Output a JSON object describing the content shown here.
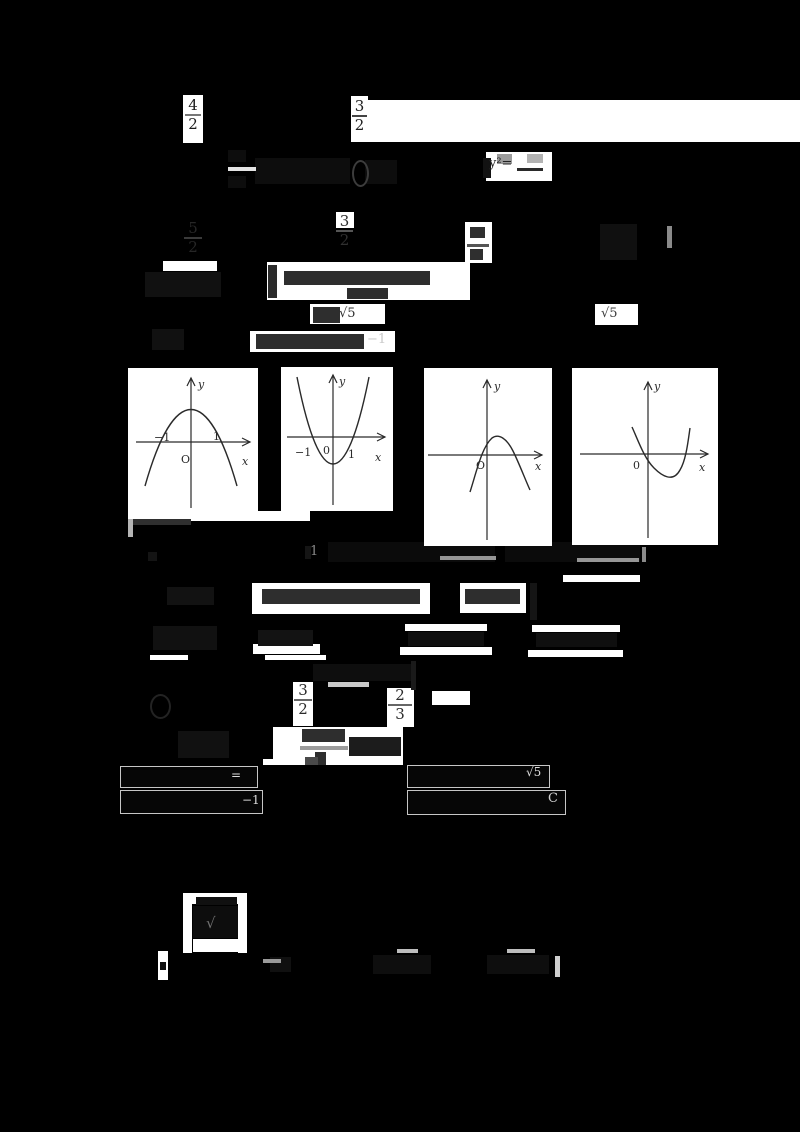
{
  "canvas": {
    "width": 800,
    "height": 1132,
    "background": "#000000"
  },
  "palette": {
    "paper": "#ffffff",
    "faint_ink": "#111111",
    "paper_ink": "#2e2e2e",
    "gray_ink": "#969696",
    "bright_ink": "#dcdcdc",
    "graph_ink": "#2a2a2a",
    "box_border": "#c6c6c6"
  },
  "paper_blocks": [
    {
      "r": [
        183,
        95,
        20,
        48
      ]
    },
    {
      "r": [
        351,
        96,
        17,
        46
      ]
    },
    {
      "r": [
        367,
        100,
        433,
        42
      ]
    },
    {
      "r": [
        486,
        152,
        66,
        29
      ]
    },
    {
      "r": [
        336,
        212,
        18,
        16
      ]
    },
    {
      "r": [
        465,
        222,
        27,
        41
      ]
    },
    {
      "r": [
        163,
        261,
        54,
        10
      ]
    },
    {
      "r": [
        267,
        262,
        203,
        38
      ]
    },
    {
      "r": [
        310,
        304,
        75,
        20
      ]
    },
    {
      "r": [
        595,
        304,
        43,
        21
      ]
    },
    {
      "r": [
        250,
        331,
        145,
        21
      ]
    },
    {
      "r": [
        618,
        230,
        18,
        26
      ]
    },
    {
      "r": [
        150,
        511,
        160,
        10
      ]
    },
    {
      "r": [
        252,
        583,
        178,
        31
      ]
    },
    {
      "r": [
        460,
        583,
        66,
        30
      ]
    },
    {
      "r": [
        563,
        575,
        77,
        7
      ]
    },
    {
      "r": [
        253,
        644,
        67,
        10
      ]
    },
    {
      "r": [
        405,
        624,
        82,
        7
      ]
    },
    {
      "r": [
        400,
        647,
        92,
        8
      ]
    },
    {
      "r": [
        532,
        625,
        88,
        7
      ]
    },
    {
      "r": [
        528,
        650,
        95,
        7
      ]
    },
    {
      "r": [
        150,
        655,
        38,
        5
      ]
    },
    {
      "r": [
        265,
        655,
        61,
        5
      ]
    },
    {
      "r": [
        293,
        682,
        20,
        44
      ]
    },
    {
      "r": [
        387,
        688,
        27,
        39
      ]
    },
    {
      "r": [
        432,
        691,
        38,
        14
      ]
    },
    {
      "r": [
        273,
        727,
        130,
        38
      ]
    },
    {
      "r": [
        263,
        759,
        127,
        6
      ]
    },
    {
      "r": [
        183,
        893,
        9,
        60
      ]
    },
    {
      "r": [
        238,
        893,
        9,
        60
      ]
    },
    {
      "r": [
        192,
        893,
        51,
        11
      ]
    },
    {
      "r": [
        193,
        939,
        50,
        13
      ]
    },
    {
      "r": [
        158,
        951,
        10,
        29
      ]
    }
  ],
  "ink_marks": [
    {
      "r": [
        228,
        167,
        28,
        4
      ],
      "c": "#e3e3e3"
    },
    {
      "r": [
        497,
        154,
        15,
        10
      ],
      "c": "#9c9c9c"
    },
    {
      "r": [
        527,
        154,
        16,
        9
      ],
      "c": "#b3b3b3"
    },
    {
      "r": [
        517,
        168,
        26,
        3
      ],
      "c": "#2a2a2a"
    },
    {
      "r": [
        467,
        244,
        22,
        3
      ],
      "c": "#555555"
    },
    {
      "r": [
        667,
        226,
        5,
        22
      ],
      "c": "#8a8a8a"
    },
    {
      "r": [
        328,
        682,
        41,
        5
      ],
      "c": "#c9c9c9"
    },
    {
      "r": [
        440,
        556,
        56,
        4
      ],
      "c": "#969696"
    },
    {
      "r": [
        577,
        558,
        62,
        4
      ],
      "c": "#969696"
    },
    {
      "r": [
        642,
        547,
        4,
        15
      ],
      "c": "#8a8a8a"
    },
    {
      "r": [
        300,
        746,
        48,
        4
      ],
      "c": "#9b9b9b"
    },
    {
      "r": [
        128,
        512,
        5,
        25
      ],
      "c": "#b5b5b5"
    },
    {
      "r": [
        263,
        959,
        18,
        4
      ],
      "c": "#9a9a9a"
    },
    {
      "r": [
        397,
        949,
        21,
        4
      ],
      "c": "#bdbdbd"
    },
    {
      "r": [
        507,
        949,
        28,
        4
      ],
      "c": "#bdbdbd"
    },
    {
      "r": [
        555,
        956,
        5,
        21
      ],
      "c": "#cfcfcf"
    },
    {
      "r": [
        480,
        799,
        16,
        3
      ],
      "c": "#8f8f8f"
    },
    {
      "r": [
        305,
        757,
        13,
        8
      ],
      "c": "#4a4a4a"
    }
  ],
  "smudges": [
    {
      "r": [
        255,
        158,
        95,
        26
      ],
      "c": "#0d0d0d"
    },
    {
      "r": [
        365,
        160,
        32,
        24
      ],
      "c": "#0d0d0d"
    },
    {
      "r": [
        228,
        150,
        18,
        12
      ],
      "c": "#0d0d0d"
    },
    {
      "r": [
        228,
        176,
        18,
        12
      ],
      "c": "#0d0d0d"
    },
    {
      "r": [
        483,
        158,
        8,
        20
      ],
      "c": "#121212"
    },
    {
      "r": [
        470,
        227,
        15,
        11
      ],
      "c": "#2f2f2f"
    },
    {
      "r": [
        470,
        249,
        13,
        11
      ],
      "c": "#2f2f2f"
    },
    {
      "r": [
        600,
        224,
        37,
        36
      ],
      "c": "#101010"
    },
    {
      "r": [
        145,
        272,
        76,
        25
      ],
      "c": "#111111"
    },
    {
      "r": [
        268,
        265,
        9,
        33
      ],
      "c": "#2b2b2b"
    },
    {
      "r": [
        284,
        271,
        146,
        14
      ],
      "c": "#2e2e2e"
    },
    {
      "r": [
        347,
        288,
        41,
        11
      ],
      "c": "#2e2e2e"
    },
    {
      "r": [
        313,
        307,
        27,
        16
      ],
      "c": "#2e2e2e"
    },
    {
      "r": [
        152,
        329,
        32,
        21
      ],
      "c": "#111111"
    },
    {
      "r": [
        256,
        334,
        108,
        15
      ],
      "c": "#2e2e2e"
    },
    {
      "r": [
        133,
        514,
        58,
        11
      ],
      "c": "#2f2f2f"
    },
    {
      "r": [
        328,
        542,
        167,
        20
      ],
      "c": "#0b0b0b"
    },
    {
      "r": [
        505,
        542,
        135,
        20
      ],
      "c": "#0b0b0b"
    },
    {
      "r": [
        305,
        546,
        6,
        13
      ],
      "c": "#151515"
    },
    {
      "r": [
        148,
        552,
        9,
        9
      ],
      "c": "#141414"
    },
    {
      "r": [
        167,
        587,
        47,
        18
      ],
      "c": "#121212"
    },
    {
      "r": [
        262,
        589,
        158,
        15
      ],
      "c": "#2e2e2e"
    },
    {
      "r": [
        465,
        589,
        55,
        15
      ],
      "c": "#2e2e2e"
    },
    {
      "r": [
        530,
        583,
        7,
        37
      ],
      "c": "#151515"
    },
    {
      "r": [
        153,
        626,
        64,
        24
      ],
      "c": "#111111"
    },
    {
      "r": [
        258,
        630,
        55,
        16
      ],
      "c": "#131313"
    },
    {
      "r": [
        408,
        632,
        76,
        14
      ],
      "c": "#0f0f0f"
    },
    {
      "r": [
        536,
        633,
        81,
        14
      ],
      "c": "#0f0f0f"
    },
    {
      "r": [
        313,
        664,
        100,
        17
      ],
      "c": "#0e0e0e"
    },
    {
      "r": [
        411,
        661,
        5,
        29
      ],
      "c": "#1a1a1a"
    },
    {
      "r": [
        178,
        731,
        51,
        27
      ],
      "c": "#111111"
    },
    {
      "r": [
        302,
        729,
        43,
        13
      ],
      "c": "#2e2e2e"
    },
    {
      "r": [
        315,
        752,
        11,
        13
      ],
      "c": "#2e2e2e"
    },
    {
      "r": [
        349,
        737,
        52,
        19
      ],
      "c": "#1c1c1c"
    },
    {
      "r": [
        135,
        770,
        92,
        11
      ],
      "c": "#161616"
    },
    {
      "r": [
        135,
        795,
        102,
        12
      ],
      "c": "#161616"
    },
    {
      "r": [
        416,
        769,
        108,
        12
      ],
      "c": "#161616"
    },
    {
      "r": [
        416,
        795,
        118,
        13
      ],
      "c": "#161616"
    },
    {
      "r": [
        196,
        897,
        41,
        8
      ],
      "c": "#101010"
    },
    {
      "r": [
        193,
        906,
        45,
        32
      ],
      "c": "#0d0d0d"
    },
    {
      "r": [
        270,
        957,
        21,
        15
      ],
      "c": "#101010"
    },
    {
      "r": [
        373,
        955,
        58,
        19
      ],
      "c": "#0e0e0e"
    },
    {
      "r": [
        487,
        955,
        62,
        19
      ],
      "c": "#0e0e0e"
    },
    {
      "r": [
        160,
        962,
        6,
        8
      ],
      "c": "#101010"
    }
  ],
  "rings": [
    {
      "r": [
        352,
        160,
        13,
        23
      ],
      "border": "#3c3c3c",
      "w": 2
    },
    {
      "r": [
        121,
        768,
        13,
        13
      ],
      "border": "#d8d8d8",
      "w": 1
    },
    {
      "r": [
        121,
        793,
        13,
        13
      ],
      "border": "#d8d8d8",
      "w": 1
    },
    {
      "r": [
        150,
        694,
        17,
        21
      ],
      "border": "#232323",
      "w": 2
    }
  ],
  "answer_boxes": [
    {
      "r": [
        120,
        766,
        136,
        20
      ]
    },
    {
      "r": [
        120,
        790,
        141,
        22
      ]
    },
    {
      "r": [
        407,
        765,
        141,
        21
      ]
    },
    {
      "r": [
        407,
        790,
        157,
        23
      ]
    }
  ],
  "fractions": [
    {
      "x": 185,
      "y": 98,
      "w": 16,
      "num": "4",
      "den": "2",
      "c": "#1d1d1d",
      "bar": "#777777",
      "s": 15
    },
    {
      "x": 352,
      "y": 99,
      "w": 15,
      "num": "3",
      "den": "2",
      "c": "#1d1d1d",
      "bar": "#444444",
      "s": 15
    },
    {
      "x": 184,
      "y": 221,
      "w": 18,
      "num": "5",
      "den": "2",
      "c": "#262626",
      "bar": "#3a3a3a",
      "s": 15
    },
    {
      "x": 336,
      "y": 214,
      "w": 17,
      "num": "3",
      "den": "2",
      "c": "#303030",
      "bar": "#555555",
      "s": 15
    },
    {
      "x": 294,
      "y": 683,
      "w": 18,
      "num": "3",
      "den": "2",
      "c": "#2b2b2b",
      "bar": "#666666",
      "s": 15
    },
    {
      "x": 388,
      "y": 688,
      "w": 24,
      "num": "2",
      "den": "3",
      "c": "#2b2b2b",
      "bar": "#666666",
      "s": 15
    }
  ],
  "text_fragments": [
    {
      "t": "y²=",
      "x": 489,
      "y": 157,
      "s": 13,
      "c": "#242424"
    },
    {
      "t": "√5",
      "x": 339,
      "y": 307,
      "s": 13,
      "c": "#2e2e2e"
    },
    {
      "t": "√5",
      "x": 601,
      "y": 307,
      "s": 13,
      "c": "#3a3a3a"
    },
    {
      "t": "−1",
      "x": 367,
      "y": 333,
      "s": 13,
      "c": "#c9c9c9"
    },
    {
      "t": "1",
      "x": 310,
      "y": 545,
      "s": 13,
      "c": "#8a8a8a"
    },
    {
      "t": "=",
      "x": 231,
      "y": 769,
      "s": 12,
      "c": "#dcdcdc"
    },
    {
      "t": "−1",
      "x": 242,
      "y": 794,
      "s": 12,
      "c": "#dcdcdc"
    },
    {
      "t": "√5",
      "x": 526,
      "y": 766,
      "s": 12,
      "c": "#dcdcdc"
    },
    {
      "t": "C",
      "x": 548,
      "y": 792,
      "s": 13,
      "c": "#cfcfcf"
    },
    {
      "t": "√",
      "x": 206,
      "y": 916,
      "s": 15,
      "c": "#6e6e6e"
    }
  ],
  "graphs": [
    {
      "name": "graph-option-1",
      "box": [
        128,
        368,
        130,
        151
      ],
      "origin": [
        63,
        74
      ],
      "x_axis": [
        8,
        122
      ],
      "y_axis": [
        10,
        140
      ],
      "curve": "parabola_down",
      "labels": [
        {
          "t": "y",
          "x": 70,
          "y": 20,
          "i": 1
        },
        {
          "t": "x",
          "x": 114,
          "y": 97,
          "i": 1
        },
        {
          "t": "O",
          "x": 53,
          "y": 95
        },
        {
          "t": "−1",
          "x": 26,
          "y": 73
        },
        {
          "t": "1",
          "x": 85,
          "y": 72
        }
      ]
    },
    {
      "name": "graph-option-2",
      "box": [
        281,
        367,
        112,
        144
      ],
      "origin": [
        52,
        70
      ],
      "x_axis": [
        6,
        104
      ],
      "y_axis": [
        8,
        138
      ],
      "curve": "parabola_up",
      "labels": [
        {
          "t": "y",
          "x": 58,
          "y": 18,
          "i": 1
        },
        {
          "t": "x",
          "x": 94,
          "y": 94,
          "i": 1
        },
        {
          "t": "−1",
          "x": 14,
          "y": 89
        },
        {
          "t": "0",
          "x": 42,
          "y": 87
        },
        {
          "t": "1",
          "x": 67,
          "y": 91
        }
      ]
    },
    {
      "name": "graph-option-3",
      "box": [
        424,
        368,
        128,
        178
      ],
      "origin": [
        63,
        87
      ],
      "x_axis": [
        4,
        118
      ],
      "y_axis": [
        12,
        172
      ],
      "curve": "cubic_max",
      "labels": [
        {
          "t": "y",
          "x": 70,
          "y": 22,
          "i": 1
        },
        {
          "t": "x",
          "x": 111,
          "y": 102,
          "i": 1
        },
        {
          "t": "O",
          "x": 52,
          "y": 101
        }
      ]
    },
    {
      "name": "graph-option-4",
      "box": [
        572,
        368,
        146,
        177
      ],
      "origin": [
        76,
        86
      ],
      "x_axis": [
        8,
        136
      ],
      "y_axis": [
        14,
        170
      ],
      "curve": "cubic_min",
      "labels": [
        {
          "t": "y",
          "x": 82,
          "y": 22,
          "i": 1
        },
        {
          "t": "x",
          "x": 127,
          "y": 103,
          "i": 1
        },
        {
          "t": "0",
          "x": 61,
          "y": 101
        }
      ]
    }
  ]
}
